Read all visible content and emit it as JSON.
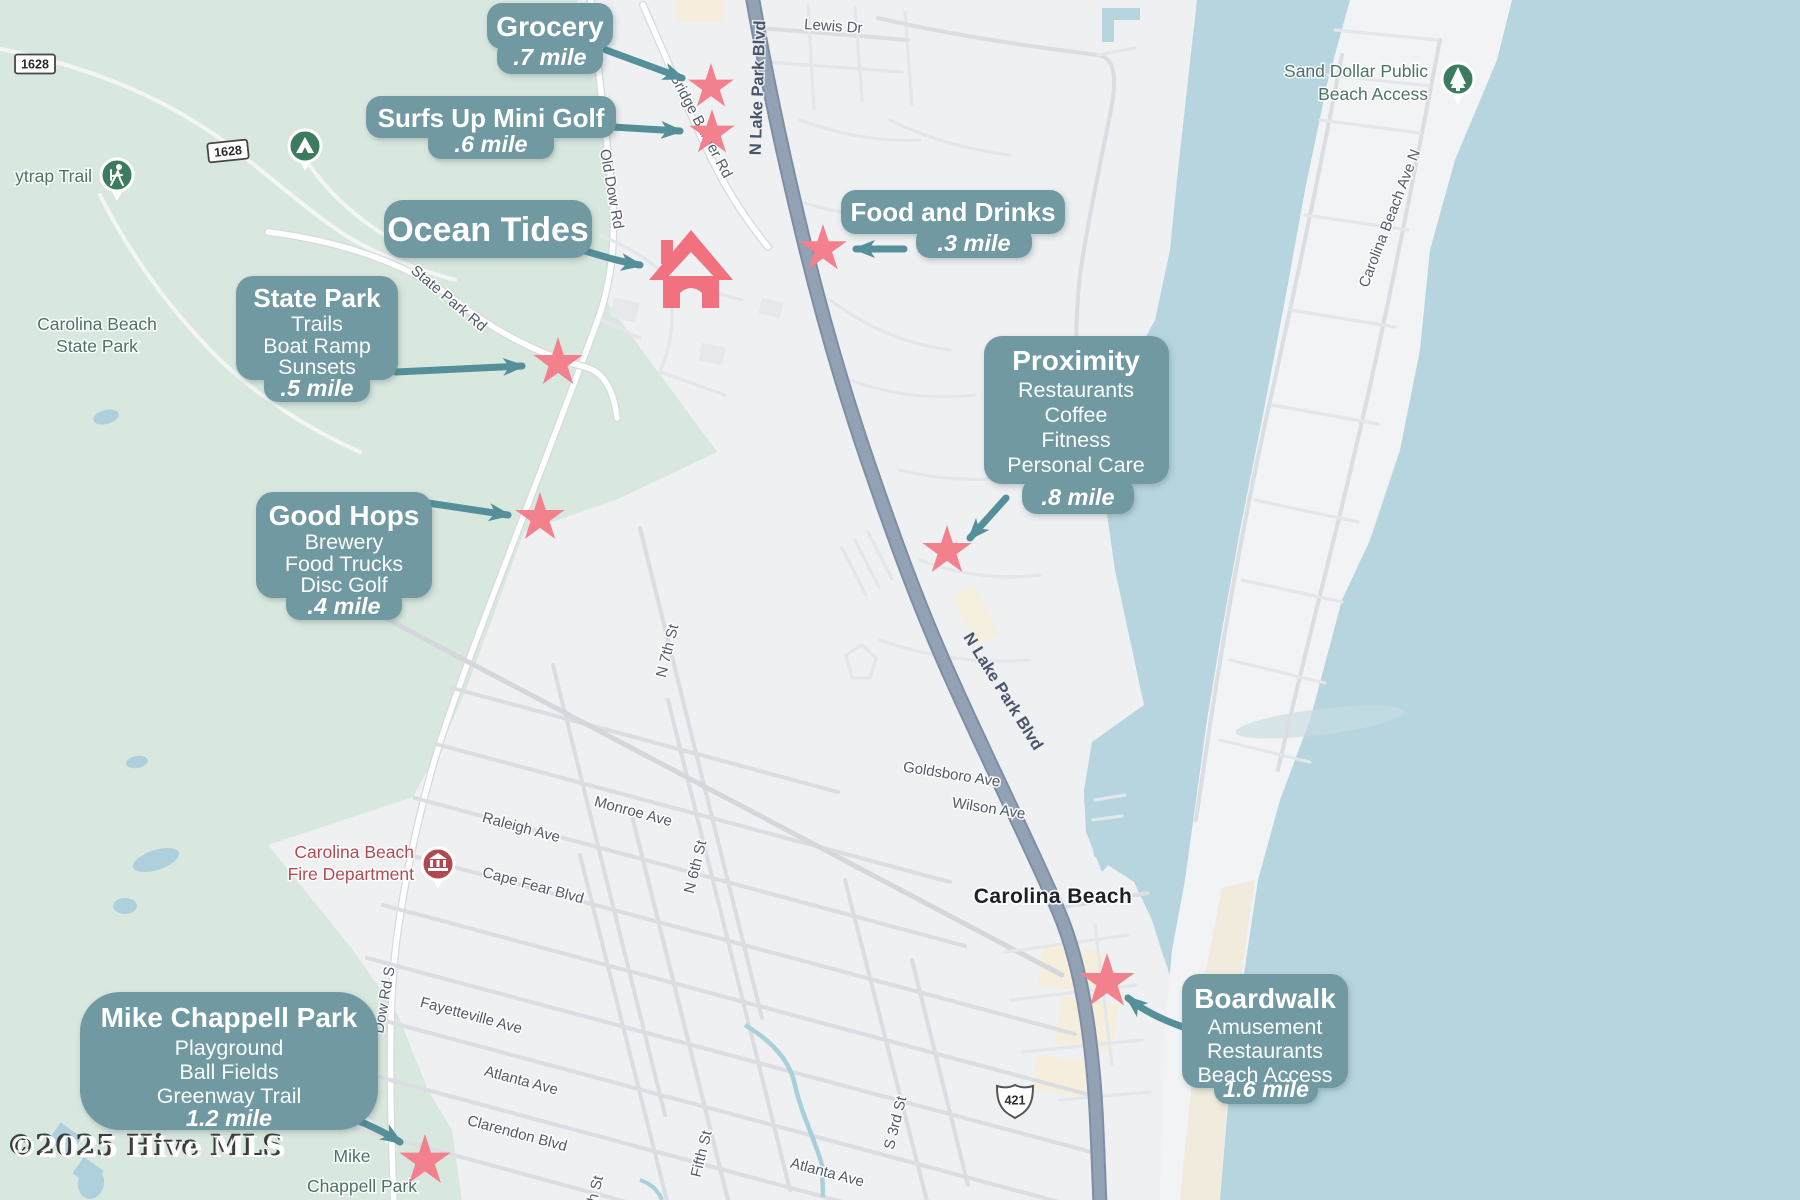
{
  "callouts": {
    "grocery": {
      "title": "Grocery",
      "distance": ".7 mile"
    },
    "surfs_up": {
      "title": "Surfs Up Mini Golf",
      "distance": ".6 mile"
    },
    "ocean_tides": {
      "title": "Ocean Tides"
    },
    "food_drinks": {
      "title": "Food and Drinks",
      "distance": ".3 mile"
    },
    "state_park": {
      "title": "State Park",
      "features": [
        "Trails",
        "Boat Ramp",
        "Sunsets"
      ],
      "distance": ".5 mile"
    },
    "good_hops": {
      "title": "Good Hops",
      "features": [
        "Brewery",
        "Food Trucks",
        "Disc Golf"
      ],
      "distance": ".4 mile"
    },
    "proximity": {
      "title": "Proximity",
      "features": [
        "Restaurants",
        "Coffee",
        "Fitness",
        "Personal Care"
      ],
      "distance": ".8 mile"
    },
    "boardwalk": {
      "title": "Boardwalk",
      "features": [
        "Amusement",
        "Restaurants",
        "Beach Access"
      ],
      "distance": "1.6 mile"
    },
    "mike_chappell": {
      "title": "Mike Chappell Park",
      "features": [
        "Playground",
        "Ball Fields",
        "Greenway Trail"
      ],
      "distance": "1.2 mile"
    }
  },
  "map_labels": {
    "lewis_dr": "Lewis Dr",
    "n_lake_park_blvd": "N Lake Park Blvd",
    "bridge_barrier_rd": "Bridge Barrier Rd",
    "old_dow_rd": "Old Dow Rd",
    "state_park_rd": "State Park Rd",
    "dow_rd_s": "Dow Rd S",
    "n_7th_st": "N 7th St",
    "n_6th_st": "N 6th St",
    "fifth_st": "Fifth St",
    "s_3rd_st": "S 3rd St",
    "partial_st": "h St",
    "monroe_ave": "Monroe Ave",
    "raleigh_ave": "Raleigh Ave",
    "cape_fear_blvd": "Cape Fear Blvd",
    "fayetteville_ave": "Fayetteville Ave",
    "atlanta_ave": "Atlanta Ave",
    "clarendon_blvd": "Clarendon Blvd",
    "goldsboro_ave": "Goldsboro Ave",
    "wilson_ave": "Wilson Ave",
    "carolina_beach_ave_n": "Carolina Beach Ave N"
  },
  "poi": {
    "city": "Carolina Beach",
    "flytrap_trail": "ytrap Trail",
    "state_park_line1": "Carolina Beach",
    "state_park_line2": "State Park",
    "sand_dollar_line1": "Sand Dollar Public",
    "sand_dollar_line2": "Beach Access",
    "fire_dept_line1": "Carolina Beach",
    "fire_dept_line2": "Fire Department",
    "mike_park_line1": "Mike",
    "mike_park_line2": "Chappell Park"
  },
  "shields": {
    "route_1628": "1628",
    "route_421": "421"
  },
  "watermark": {
    "text": "©2025 Hive MLS"
  },
  "colors": {
    "bubble": "#6f99a1",
    "arrow": "#55909a",
    "star": "#f3808d",
    "house": "#f2717f",
    "water": "#b6d5de",
    "park_green": "#d9e8df",
    "urban": "#eef0f2",
    "major_road": "#93a1b4",
    "pin_green": "#3c7b5e",
    "pin_red": "#b2484f"
  }
}
